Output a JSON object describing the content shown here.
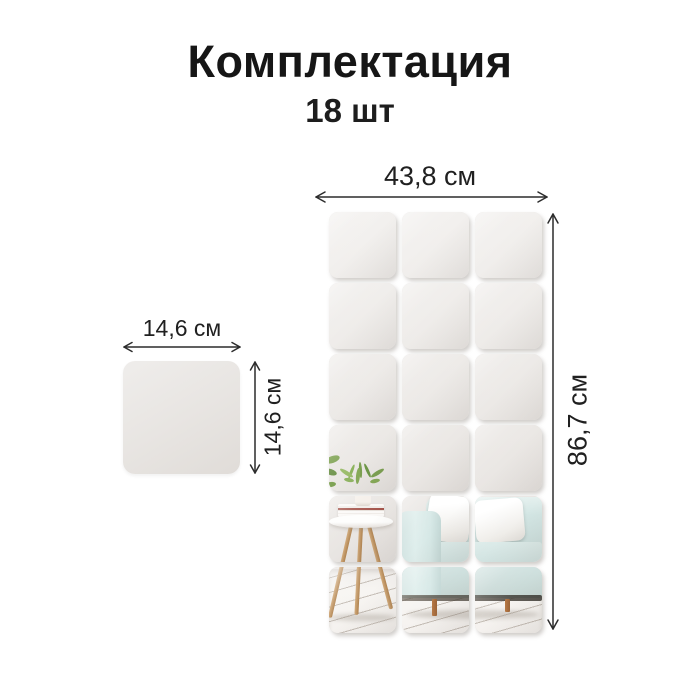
{
  "title": "Комплектация",
  "subtitle": "18 шт",
  "assembled_grid": {
    "rows": 6,
    "cols": 3,
    "tile_count": 18,
    "width_label": "43,8 см",
    "height_label": "86,7 см"
  },
  "single_tile": {
    "width_label": "14,6 см",
    "height_label": "14,6 см"
  },
  "scene": {
    "description": "mirror reflection: mint sofa with white pillows, wooden three-leg side table with books and green potted plant, white plank floor"
  },
  "colors": {
    "text": "#1a1a1a",
    "arrow": "#2c2c2c",
    "tile_gray": "#eae7e4",
    "sofa_mint": "#cfe2e0",
    "pillow_white": "#f7f6f4",
    "wood_tan": "#c49a6a",
    "plant_green": "#7ca24f"
  }
}
